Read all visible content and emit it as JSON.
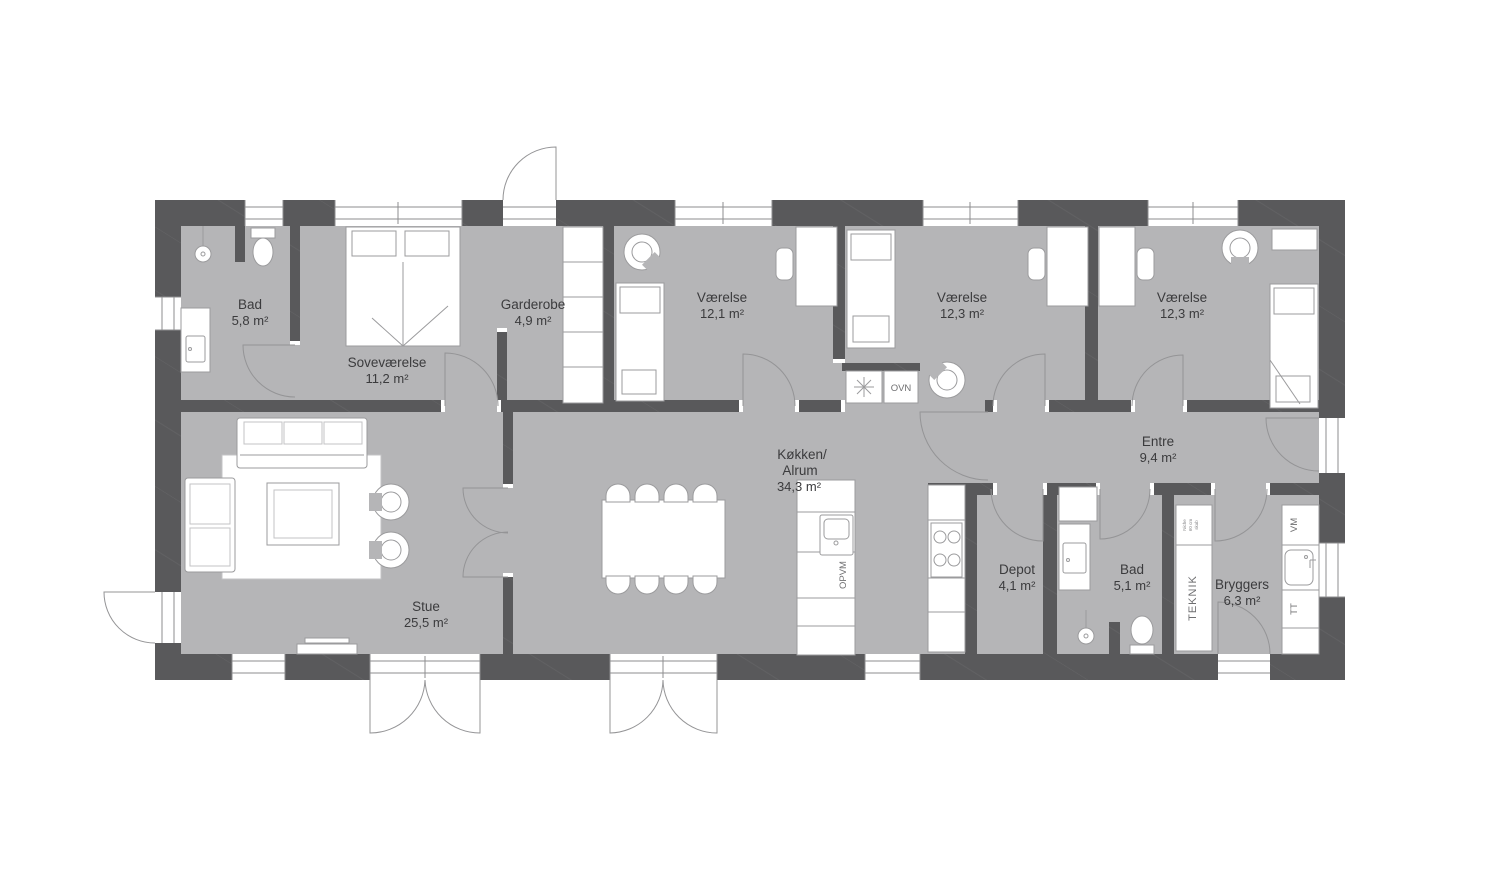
{
  "plan": {
    "rooms": [
      {
        "label": "Bad",
        "area": "5,8 m²"
      },
      {
        "label": "Soveværelse",
        "area": "11,2 m²"
      },
      {
        "label": "Garderobe",
        "area": "4,9 m²"
      },
      {
        "label": "Værelse",
        "area": "12,1 m²"
      },
      {
        "label": "Værelse",
        "area": "12,3 m²"
      },
      {
        "label": "Værelse",
        "area": "12,3 m²"
      },
      {
        "label": "Entre",
        "area": "9,4 m²"
      },
      {
        "label": "Køkken/",
        "label2": "Alrum",
        "area": "34,3 m²"
      },
      {
        "label": "Stue",
        "area": "25,5 m²"
      },
      {
        "label": "Depot",
        "area": "4,1 m²"
      },
      {
        "label": "Bad",
        "area": "5,1 m²"
      },
      {
        "label": "Bryggers",
        "area": "6,3 m²"
      }
    ],
    "appliances": {
      "oven": "OVN",
      "dishwasher": "OPVM",
      "washing_machine": "VM",
      "tumble_dryer": "TT",
      "technical_cabinet": "TEKNIK",
      "cabinet_note_lines": [
        "Niche",
        "60 cm",
        "skab"
      ]
    },
    "colors": {
      "wall": "#59595b",
      "floor": "#b5b5b7",
      "background": "#ffffff",
      "furniture_outline": "#9b9b9d",
      "label_text": "#3b3b3d"
    }
  }
}
